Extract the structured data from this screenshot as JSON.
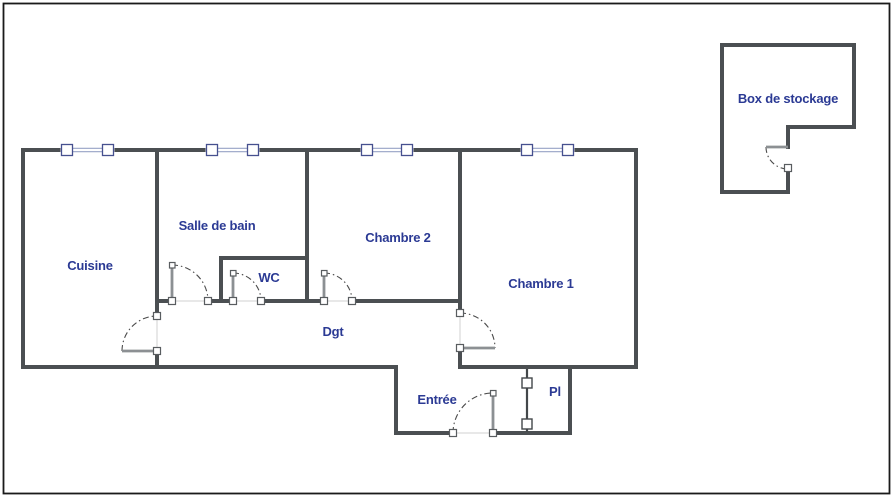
{
  "plan": {
    "labels": {
      "cuisine": "Cuisine",
      "salle_de_bain": "Salle de bain",
      "wc": "WC",
      "chambre2": "Chambre 2",
      "chambre1": "Chambre 1",
      "dgt": "Dgt",
      "entree": "Entrée",
      "pl": "Pl",
      "box_de_stockage": "Box de stockage"
    },
    "colors": {
      "wall": "#4b4f52",
      "label_text": "#2b3a94",
      "window_frame": "#46508f",
      "window_glass": "#97a2c6",
      "door_leaf": "#8c9093",
      "door_arc": "#4a4a4a",
      "jamb_stroke": "#595d60",
      "threshold": "#d9d9d9",
      "border": "#1a1a1a",
      "background": "#ffffff"
    }
  }
}
